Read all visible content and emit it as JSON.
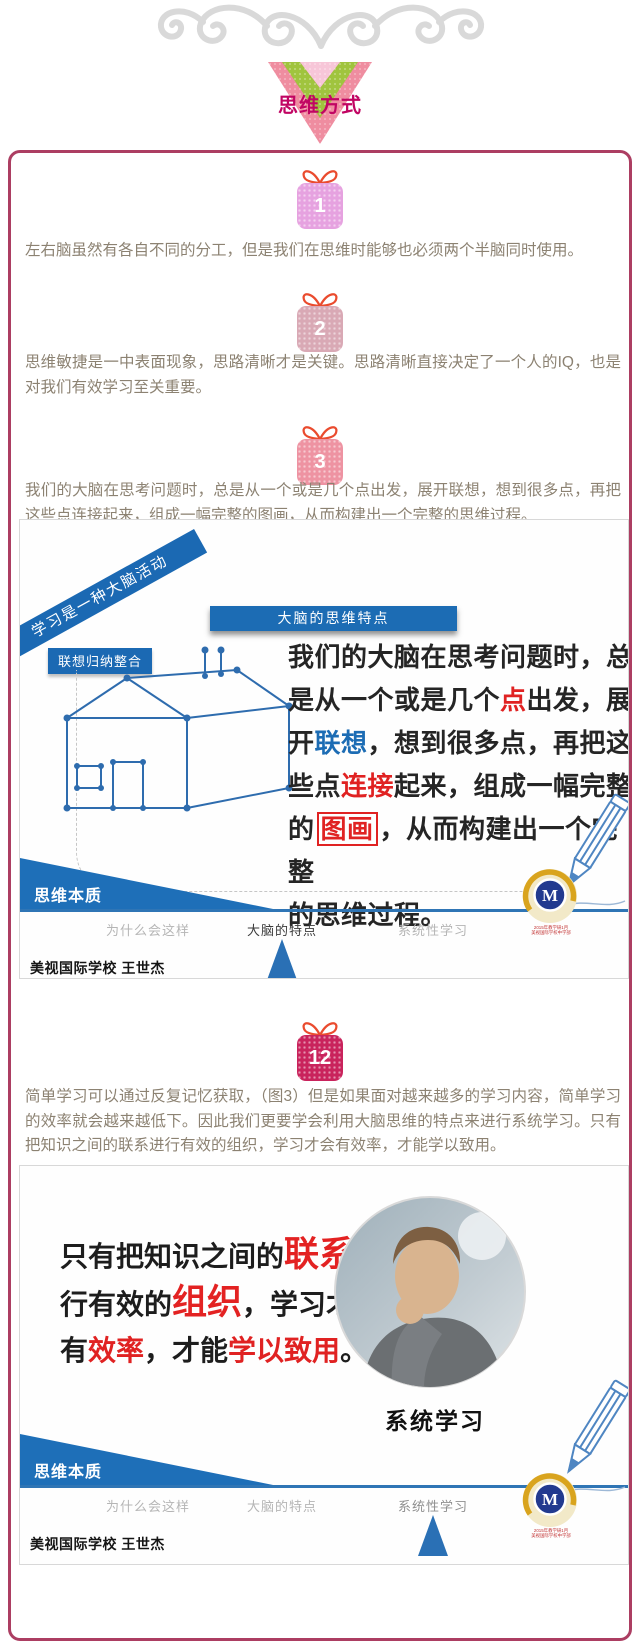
{
  "banner": {
    "title": "思维方式"
  },
  "sections": [
    {
      "badge": "1",
      "text": "左右脑虽然有各自不同的分工，但是我们在思维时能够也必须两个半脑同时使用。"
    },
    {
      "badge": "2",
      "text": "思维敏捷是一中表面现象，思路清晰才是关键。思路清晰直接决定了一个人的IQ，也是对我们有效学习至关重要。"
    },
    {
      "badge": "3",
      "text": "我们的大脑在思考问题时，总是从一个或是几个点出发，展开联想，想到很多点，再把这些点连接起来，组成一幅完整的图画，从而构建出一个完整的思维过程。"
    },
    {
      "badge": "12",
      "text": "简单学习可以通过反复记忆获取，（图3）但是如果面对越来越多的学习内容，简单学习的效率就会越来越低下。因此我们更要学会利用大脑思维的特点来进行系统学习。只有把知识之间的联系进行有效的组织，学习才会有效率，才能学以致用。"
    }
  ],
  "slide1": {
    "ribbon": "学习是一种大脑活动",
    "tag": "联想归纳整合",
    "header": "大脑的思维特点",
    "body_segments": [
      {
        "t": "我们的大脑在思考问题时，总",
        "s": "n"
      },
      {
        "t": "",
        "s": "br"
      },
      {
        "t": "是从一个或是几个",
        "s": "n"
      },
      {
        "t": "点",
        "s": "red"
      },
      {
        "t": "出发，展",
        "s": "n"
      },
      {
        "t": "",
        "s": "br"
      },
      {
        "t": "开",
        "s": "n"
      },
      {
        "t": "联想",
        "s": "blue"
      },
      {
        "t": "，想到很多点，再把这",
        "s": "n"
      },
      {
        "t": "",
        "s": "br"
      },
      {
        "t": "些点",
        "s": "n"
      },
      {
        "t": "连接",
        "s": "red"
      },
      {
        "t": "起来，组成一幅完整",
        "s": "n"
      },
      {
        "t": "",
        "s": "br"
      },
      {
        "t": "的",
        "s": "n"
      },
      {
        "t": "图画",
        "s": "redbox"
      },
      {
        "t": "，从而构建出一个完整",
        "s": "n"
      },
      {
        "t": "",
        "s": "br"
      },
      {
        "t": "的思维过程。",
        "s": "n"
      }
    ],
    "footer": {
      "wedge": "思维本质",
      "nav": [
        {
          "label": "为什么会这样",
          "active": false
        },
        {
          "label": "大脑的特点",
          "active": true
        },
        {
          "label": "系统性学习",
          "active": false
        }
      ],
      "credit": "美视国际学校 王世杰"
    },
    "watermark": [
      "2015年教学研1月",
      "美视国际学校中学部"
    ]
  },
  "slide2": {
    "headline_segments": [
      {
        "t": "只有把知识之间的",
        "s": "n"
      },
      {
        "t": "联系",
        "s": "redbig"
      },
      {
        "t": "进",
        "s": "n"
      },
      {
        "t": "",
        "s": "br"
      },
      {
        "t": "行有效的",
        "s": "n"
      },
      {
        "t": "组织",
        "s": "redbig"
      },
      {
        "t": "，学习才会",
        "s": "n"
      },
      {
        "t": "",
        "s": "br"
      },
      {
        "t": "有",
        "s": "n"
      },
      {
        "t": "效率",
        "s": "red"
      },
      {
        "t": "，才能",
        "s": "n"
      },
      {
        "t": "学以致用",
        "s": "red"
      },
      {
        "t": "。",
        "s": "n"
      }
    ],
    "caption": "系统学习",
    "footer": {
      "wedge": "思维本质",
      "nav": [
        {
          "label": "为什么会这样",
          "active": false
        },
        {
          "label": "大脑的特点",
          "active": false
        },
        {
          "label": "系统性学习",
          "active": false
        }
      ],
      "credit": "美视国际学校 王世杰"
    },
    "watermark": [
      "2015年教学研1月",
      "美视国际学校中学部"
    ]
  },
  "colors": {
    "accent_blue": "#1c6cb4",
    "card_border_pink": "#ac3e62",
    "highlight_red": "#e02222",
    "banner_text": "#c10563"
  }
}
